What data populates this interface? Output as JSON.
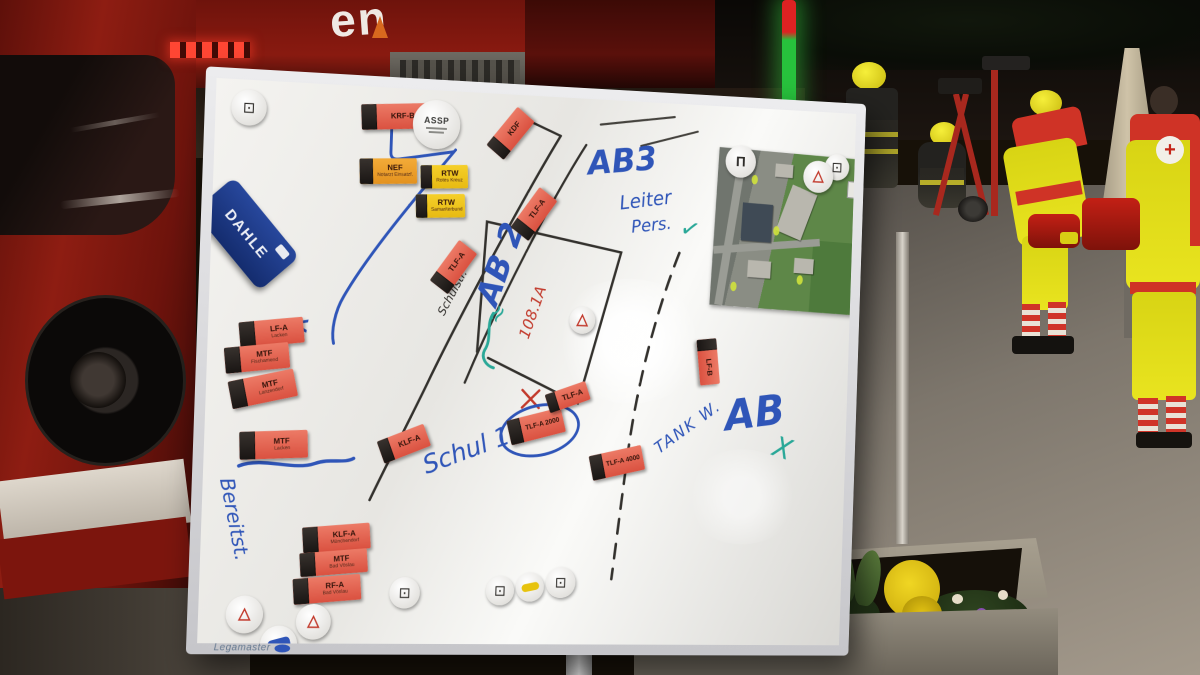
{
  "board": {
    "brand": "Legamaster",
    "eraser_brand": "DAHLE",
    "magnets": [
      {
        "label": "KRF-B",
        "sub": "",
        "color": "red"
      },
      {
        "label": "ASSP",
        "sub": "",
        "color": "white"
      },
      {
        "label": "NEF",
        "sub": "Notarzt Einsatzf.",
        "color": "orange"
      },
      {
        "label": "RTW",
        "sub": "Rotes Kreuz",
        "color": "yellow"
      },
      {
        "label": "RTW",
        "sub": "Samariterbund",
        "color": "yellow"
      },
      {
        "label": "KDF",
        "sub": "",
        "color": "red"
      },
      {
        "label": "TLF-A",
        "sub": "",
        "color": "red"
      },
      {
        "label": "TLF-A",
        "sub": "",
        "color": "red"
      },
      {
        "label": "LF-A",
        "sub": "Lacken",
        "color": "red"
      },
      {
        "label": "MTF",
        "sub": "Fischamend",
        "color": "red"
      },
      {
        "label": "MTF",
        "sub": "Lanzendorf",
        "color": "red"
      },
      {
        "label": "MTF",
        "sub": "Lacken",
        "color": "red"
      },
      {
        "label": "KLF-A",
        "sub": "",
        "color": "red"
      },
      {
        "label": "TLF-A 2000",
        "sub": "",
        "color": "red"
      },
      {
        "label": "TLF-A",
        "sub": "",
        "color": "red"
      },
      {
        "label": "TLF-A 4000",
        "sub": "",
        "color": "red"
      },
      {
        "label": "LF-B",
        "sub": "",
        "color": "red"
      },
      {
        "label": "KLF-A",
        "sub": "Münchendorf",
        "color": "red"
      },
      {
        "label": "MTF",
        "sub": "Bad Vöslau",
        "color": "red"
      },
      {
        "label": "RF-A",
        "sub": "Bad Vöslau",
        "color": "red"
      }
    ],
    "annotations": [
      {
        "text": "AB3",
        "color": "blue"
      },
      {
        "text": "Leiter",
        "color": "blue"
      },
      {
        "text": "Pers.",
        "color": "blue"
      },
      {
        "text": "✓",
        "color": "teal"
      },
      {
        "text": "AB 2",
        "color": "blue"
      },
      {
        "text": "Schulstr.",
        "color": "black"
      },
      {
        "text": "108.1A",
        "color": "red"
      },
      {
        "text": "Schul 10",
        "color": "blue"
      },
      {
        "text": "TANK W.",
        "color": "blue"
      },
      {
        "text": "AB",
        "color": "blue"
      },
      {
        "text": "X",
        "color": "teal"
      },
      {
        "text": "Bereitst.",
        "color": "blue"
      },
      {
        "text": "<",
        "color": "blue"
      },
      {
        "text": "≈",
        "color": "teal"
      }
    ]
  },
  "icons": {
    "tactical_square": "⊡",
    "warning_triangle": "△",
    "gate_symbol": "Π",
    "red_cross": "+"
  },
  "background": {
    "truck_marking": "en"
  },
  "colors": {
    "marker_blue": "#2f55b8",
    "marker_teal": "#2aa898",
    "marker_red": "#c23a2c",
    "marker_black": "#2c2c2c",
    "magnet_red": "#e2604e",
    "magnet_orange": "#f2a028",
    "magnet_yellow": "#f2c51c",
    "eraser_blue": "#1d3f8f",
    "hivis_yellow": "#e9e41f",
    "fire_red": "#8a1a10"
  }
}
